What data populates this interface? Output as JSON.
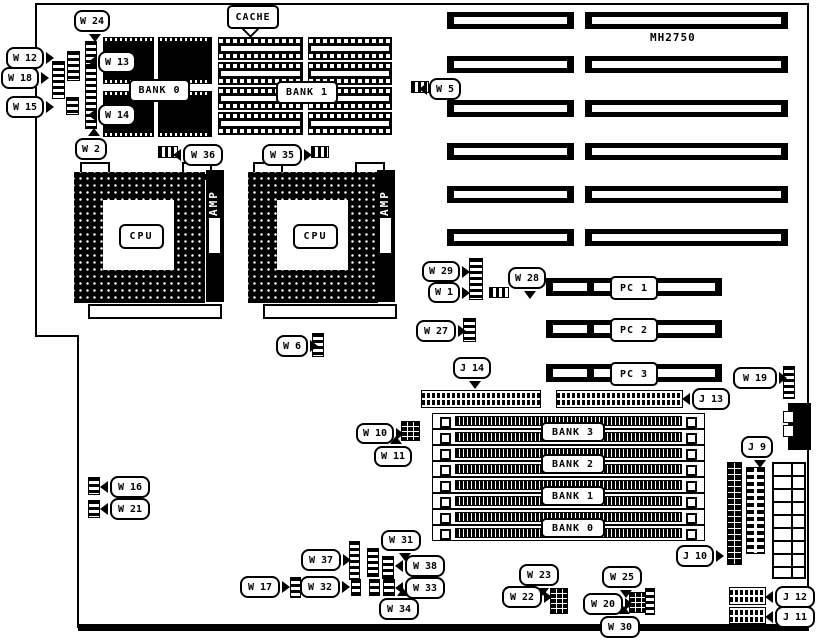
{
  "model": "MH2750",
  "labels": {
    "cache": "CACHE",
    "bank0": "BANK 0",
    "bank1": "BANK 1",
    "cpu": "CPU",
    "amp": "AMP"
  },
  "memory_banks": [
    "BANK 3",
    "BANK 2",
    "BANK 1",
    "BANK 0"
  ],
  "pci_slots": [
    {
      "label": "PC 1",
      "x": 546,
      "y": 278,
      "w": 176,
      "h": 18
    },
    {
      "label": "PC 2",
      "x": 546,
      "y": 320,
      "w": 176,
      "h": 18
    },
    {
      "label": "PC 3",
      "x": 546,
      "y": 364,
      "w": 176,
      "h": 18
    }
  ],
  "isa": {
    "columns": [
      {
        "x": 447,
        "w": 127
      },
      {
        "x": 585,
        "w": 203
      }
    ],
    "row_ys": [
      12,
      56,
      100,
      143,
      186,
      229
    ],
    "h": 17
  },
  "simm": {
    "x": 432,
    "w": 271,
    "h": 14,
    "row_ys": [
      413,
      429,
      445,
      461,
      477,
      493,
      509,
      525
    ],
    "bank_label_ys": [
      422,
      454,
      486,
      518
    ],
    "bank_label_x": 541,
    "bank_label_w": 60,
    "bank_label_h": 16
  },
  "dram_chips": [
    {
      "x": 103,
      "y": 37,
      "w": 51,
      "h": 47
    },
    {
      "x": 158,
      "y": 37,
      "w": 54,
      "h": 47
    },
    {
      "x": 103,
      "y": 91,
      "w": 51,
      "h": 46
    },
    {
      "x": 158,
      "y": 91,
      "w": 54,
      "h": 46
    }
  ],
  "cache_chips": [
    {
      "x": 218,
      "y": 37,
      "w": 85,
      "h": 23
    },
    {
      "x": 308,
      "y": 37,
      "w": 84,
      "h": 23
    },
    {
      "x": 218,
      "y": 62,
      "w": 85,
      "h": 23
    },
    {
      "x": 308,
      "y": 62,
      "w": 84,
      "h": 23
    },
    {
      "x": 218,
      "y": 87,
      "w": 85,
      "h": 23
    },
    {
      "x": 308,
      "y": 87,
      "w": 84,
      "h": 23
    },
    {
      "x": 218,
      "y": 112,
      "w": 85,
      "h": 23
    },
    {
      "x": 308,
      "y": 112,
      "w": 84,
      "h": 23
    }
  ],
  "pin_headers": [
    {
      "id": "j14",
      "o": "h",
      "x": 421,
      "y": 390,
      "w": 118,
      "h": 16
    },
    {
      "id": "j13",
      "o": "h",
      "x": 556,
      "y": 390,
      "w": 125,
      "h": 16
    },
    {
      "id": "j12",
      "o": "h",
      "x": 729,
      "y": 587,
      "w": 35,
      "h": 16
    },
    {
      "id": "j11",
      "o": "h",
      "x": 729,
      "y": 607,
      "w": 35,
      "h": 15
    },
    {
      "id": "j9",
      "o": "v",
      "x": 746,
      "y": 467,
      "w": 17,
      "h": 85
    },
    {
      "id": "j10",
      "o": "s",
      "x": 727,
      "y": 462,
      "w": 13,
      "h": 101
    }
  ],
  "jumpers": [
    {
      "id": "w24",
      "k": "v",
      "x": 85,
      "y": 41,
      "w": 10,
      "h": 22
    },
    {
      "id": "w12",
      "k": "v",
      "x": 67,
      "y": 51,
      "w": 11,
      "h": 28
    },
    {
      "id": "w18",
      "k": "v",
      "x": 52,
      "y": 61,
      "w": 11,
      "h": 36
    },
    {
      "id": "w15",
      "k": "v",
      "x": 66,
      "y": 97,
      "w": 11,
      "h": 16
    },
    {
      "id": "w13-w14",
      "k": "v",
      "x": 85,
      "y": 65,
      "w": 10,
      "h": 62
    },
    {
      "id": "w36",
      "k": "h",
      "x": 158,
      "y": 146,
      "w": 18,
      "h": 10
    },
    {
      "id": "w35",
      "k": "h",
      "x": 311,
      "y": 146,
      "w": 16,
      "h": 10
    },
    {
      "id": "w5",
      "k": "h",
      "x": 411,
      "y": 81,
      "w": 16,
      "h": 10
    },
    {
      "id": "w29-w1",
      "k": "v",
      "x": 469,
      "y": 258,
      "w": 12,
      "h": 40
    },
    {
      "id": "w28",
      "k": "h",
      "x": 489,
      "y": 287,
      "w": 18,
      "h": 9
    },
    {
      "id": "w27",
      "k": "v",
      "x": 463,
      "y": 318,
      "w": 11,
      "h": 22
    },
    {
      "id": "w6",
      "k": "v",
      "x": 312,
      "y": 333,
      "w": 10,
      "h": 22
    },
    {
      "id": "w19",
      "k": "v",
      "x": 783,
      "y": 366,
      "w": 10,
      "h": 31
    },
    {
      "id": "w10-w11",
      "k": "g",
      "x": 401,
      "y": 421,
      "w": 17,
      "h": 18
    },
    {
      "id": "w16",
      "k": "v",
      "x": 88,
      "y": 477,
      "w": 10,
      "h": 16
    },
    {
      "id": "w21",
      "k": "v",
      "x": 88,
      "y": 500,
      "w": 10,
      "h": 16
    },
    {
      "id": "w37",
      "k": "v",
      "x": 349,
      "y": 541,
      "w": 9,
      "h": 37
    },
    {
      "id": "w31",
      "k": "v",
      "x": 367,
      "y": 548,
      "w": 10,
      "h": 27
    },
    {
      "id": "w38",
      "k": "v",
      "x": 382,
      "y": 556,
      "w": 10,
      "h": 21
    },
    {
      "id": "w17",
      "k": "v",
      "x": 290,
      "y": 577,
      "w": 9,
      "h": 19
    },
    {
      "id": "w32",
      "k": "v",
      "x": 351,
      "y": 579,
      "w": 8,
      "h": 15
    },
    {
      "id": "w34",
      "k": "v",
      "x": 369,
      "y": 579,
      "w": 9,
      "h": 15
    },
    {
      "id": "w33",
      "k": "v",
      "x": 383,
      "y": 579,
      "w": 10,
      "h": 15
    },
    {
      "id": "w22-w23",
      "k": "g",
      "x": 550,
      "y": 588,
      "w": 16,
      "h": 24
    },
    {
      "id": "w20-w25",
      "k": "g",
      "x": 629,
      "y": 592,
      "w": 16,
      "h": 19
    },
    {
      "id": "w30",
      "k": "v",
      "x": 645,
      "y": 588,
      "w": 8,
      "h": 25
    }
  ],
  "callouts": [
    {
      "id": "w24",
      "text": "W 24",
      "x": 74,
      "y": 10,
      "w": 32,
      "h": 18,
      "tail": "b"
    },
    {
      "id": "w12",
      "text": "W 12",
      "x": 6,
      "y": 47,
      "w": 34,
      "h": 18,
      "tail": "r"
    },
    {
      "id": "w18",
      "text": "W 18",
      "x": 1,
      "y": 67,
      "w": 34,
      "h": 18,
      "tail": "r"
    },
    {
      "id": "w15",
      "text": "W 15",
      "x": 6,
      "y": 96,
      "w": 34,
      "h": 18,
      "tail": "r"
    },
    {
      "id": "w13",
      "text": "W 13",
      "x": 98,
      "y": 51,
      "w": 34,
      "h": 18,
      "tail": "l"
    },
    {
      "id": "w14",
      "text": "W 14",
      "x": 98,
      "y": 104,
      "w": 34,
      "h": 18,
      "tail": "l"
    },
    {
      "id": "w2",
      "text": "W 2",
      "x": 75,
      "y": 138,
      "w": 28,
      "h": 18,
      "tail": "t"
    },
    {
      "id": "w36",
      "text": "W 36",
      "x": 183,
      "y": 144,
      "w": 36,
      "h": 18,
      "tail": "l"
    },
    {
      "id": "w35",
      "text": "W 35",
      "x": 262,
      "y": 144,
      "w": 36,
      "h": 18,
      "tail": "r"
    },
    {
      "id": "w5",
      "text": "W 5",
      "x": 429,
      "y": 78,
      "w": 28,
      "h": 18,
      "tail": "l"
    },
    {
      "id": "w29",
      "text": "W 29",
      "x": 422,
      "y": 261,
      "w": 34,
      "h": 17,
      "tail": "r"
    },
    {
      "id": "w1",
      "text": "W 1",
      "x": 428,
      "y": 282,
      "w": 28,
      "h": 17,
      "tail": "r"
    },
    {
      "id": "w28",
      "text": "W 28",
      "x": 508,
      "y": 267,
      "w": 34,
      "h": 18,
      "tail": "b"
    },
    {
      "id": "w27",
      "text": "W 27",
      "x": 416,
      "y": 320,
      "w": 36,
      "h": 18,
      "tail": "r"
    },
    {
      "id": "w6",
      "text": "W 6",
      "x": 276,
      "y": 335,
      "w": 28,
      "h": 18,
      "tail": "r"
    },
    {
      "id": "j14",
      "text": "J 14",
      "x": 453,
      "y": 357,
      "w": 34,
      "h": 18,
      "tail": "b"
    },
    {
      "id": "j13",
      "text": "J 13",
      "x": 692,
      "y": 388,
      "w": 34,
      "h": 18,
      "tail": "l"
    },
    {
      "id": "w19",
      "text": "W 19",
      "x": 733,
      "y": 367,
      "w": 40,
      "h": 18,
      "tail": "r"
    },
    {
      "id": "w10",
      "text": "W 10",
      "x": 356,
      "y": 423,
      "w": 34,
      "h": 17,
      "tail": "r"
    },
    {
      "id": "w11",
      "text": "W 11",
      "x": 374,
      "y": 446,
      "w": 34,
      "h": 17,
      "tail": "t"
    },
    {
      "id": "j9",
      "text": "J 9",
      "x": 741,
      "y": 436,
      "w": 28,
      "h": 18,
      "tail": "b"
    },
    {
      "id": "w16",
      "text": "W 16",
      "x": 110,
      "y": 476,
      "w": 36,
      "h": 18,
      "tail": "l"
    },
    {
      "id": "w21",
      "text": "W 21",
      "x": 110,
      "y": 498,
      "w": 36,
      "h": 18,
      "tail": "l"
    },
    {
      "id": "w37",
      "text": "W 37",
      "x": 301,
      "y": 549,
      "w": 36,
      "h": 18,
      "tail": "r"
    },
    {
      "id": "w31",
      "text": "W 31",
      "x": 381,
      "y": 530,
      "w": 36,
      "h": 17,
      "tail": "b"
    },
    {
      "id": "w38",
      "text": "W 38",
      "x": 405,
      "y": 555,
      "w": 36,
      "h": 18,
      "tail": "l"
    },
    {
      "id": "w17",
      "text": "W 17",
      "x": 240,
      "y": 576,
      "w": 36,
      "h": 18,
      "tail": "r"
    },
    {
      "id": "w32",
      "text": "W 32",
      "x": 300,
      "y": 576,
      "w": 36,
      "h": 18,
      "tail": "r"
    },
    {
      "id": "w33",
      "text": "W 33",
      "x": 405,
      "y": 577,
      "w": 36,
      "h": 18,
      "tail": "l"
    },
    {
      "id": "w34",
      "text": "W 34",
      "x": 379,
      "y": 598,
      "w": 36,
      "h": 18,
      "tail": "t"
    },
    {
      "id": "w23",
      "text": "W 23",
      "x": 519,
      "y": 564,
      "w": 36,
      "h": 18,
      "tail": "b"
    },
    {
      "id": "w22",
      "text": "W 22",
      "x": 502,
      "y": 586,
      "w": 36,
      "h": 18,
      "tail": "r"
    },
    {
      "id": "w25",
      "text": "W 25",
      "x": 602,
      "y": 566,
      "w": 36,
      "h": 18,
      "tail": "b"
    },
    {
      "id": "w20",
      "text": "W 20",
      "x": 583,
      "y": 593,
      "w": 36,
      "h": 18,
      "tail": "r"
    },
    {
      "id": "w30",
      "text": "W 30",
      "x": 600,
      "y": 616,
      "w": 36,
      "h": 18,
      "tail": "t"
    },
    {
      "id": "j10",
      "text": "J 10",
      "x": 676,
      "y": 545,
      "w": 34,
      "h": 18,
      "tail": "r"
    },
    {
      "id": "j12",
      "text": "J 12",
      "x": 775,
      "y": 586,
      "w": 36,
      "h": 18,
      "tail": "l"
    },
    {
      "id": "j11",
      "text": "J 11",
      "x": 775,
      "y": 606,
      "w": 36,
      "h": 18,
      "tail": "l"
    }
  ]
}
